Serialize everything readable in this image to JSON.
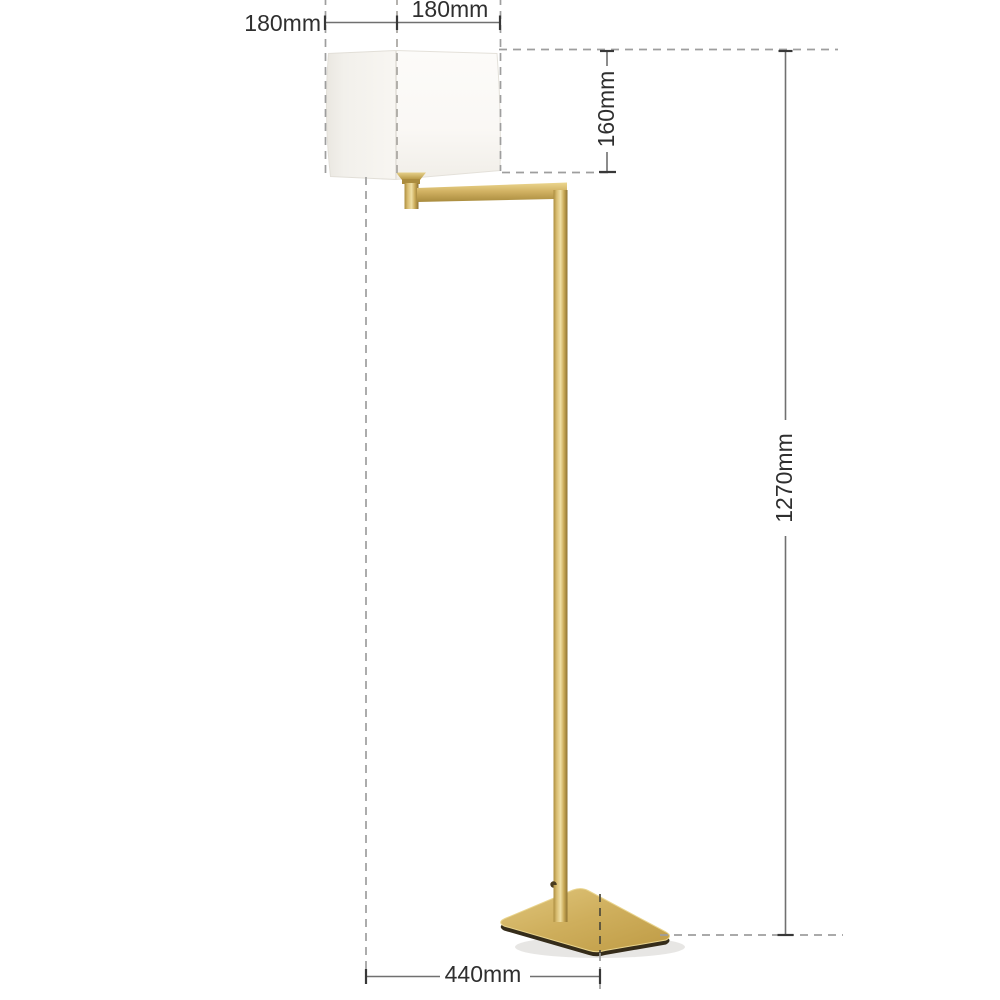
{
  "diagram": {
    "type": "product-dimension-diagram",
    "product": "swing-arm floor lamp with square shade and square base",
    "labels": {
      "shade_width_left": "180mm",
      "shade_width_right": "180mm",
      "shade_height": "160mm",
      "total_height": "1270mm",
      "base_width": "440mm"
    },
    "dimensions": [
      {
        "name": "shade width left segment",
        "value": "180mm",
        "orientation": "horizontal"
      },
      {
        "name": "shade width right segment",
        "value": "180mm",
        "orientation": "horizontal"
      },
      {
        "name": "shade height",
        "value": "160mm",
        "orientation": "vertical"
      },
      {
        "name": "total lamp height",
        "value": "1270mm",
        "orientation": "vertical"
      },
      {
        "name": "base width",
        "value": "440mm",
        "orientation": "horizontal"
      }
    ],
    "colors": {
      "background": "#ffffff",
      "brass": "#cfae5c",
      "brass_light": "#eed995",
      "brass_dark": "#9c7f36",
      "base_underside": "#352c1a",
      "shade_white": "#f7f5f1",
      "dimension_line": "#707070",
      "tick": "#383838",
      "dash": "#9e9e9e",
      "text": "#2f2f2f"
    }
  }
}
